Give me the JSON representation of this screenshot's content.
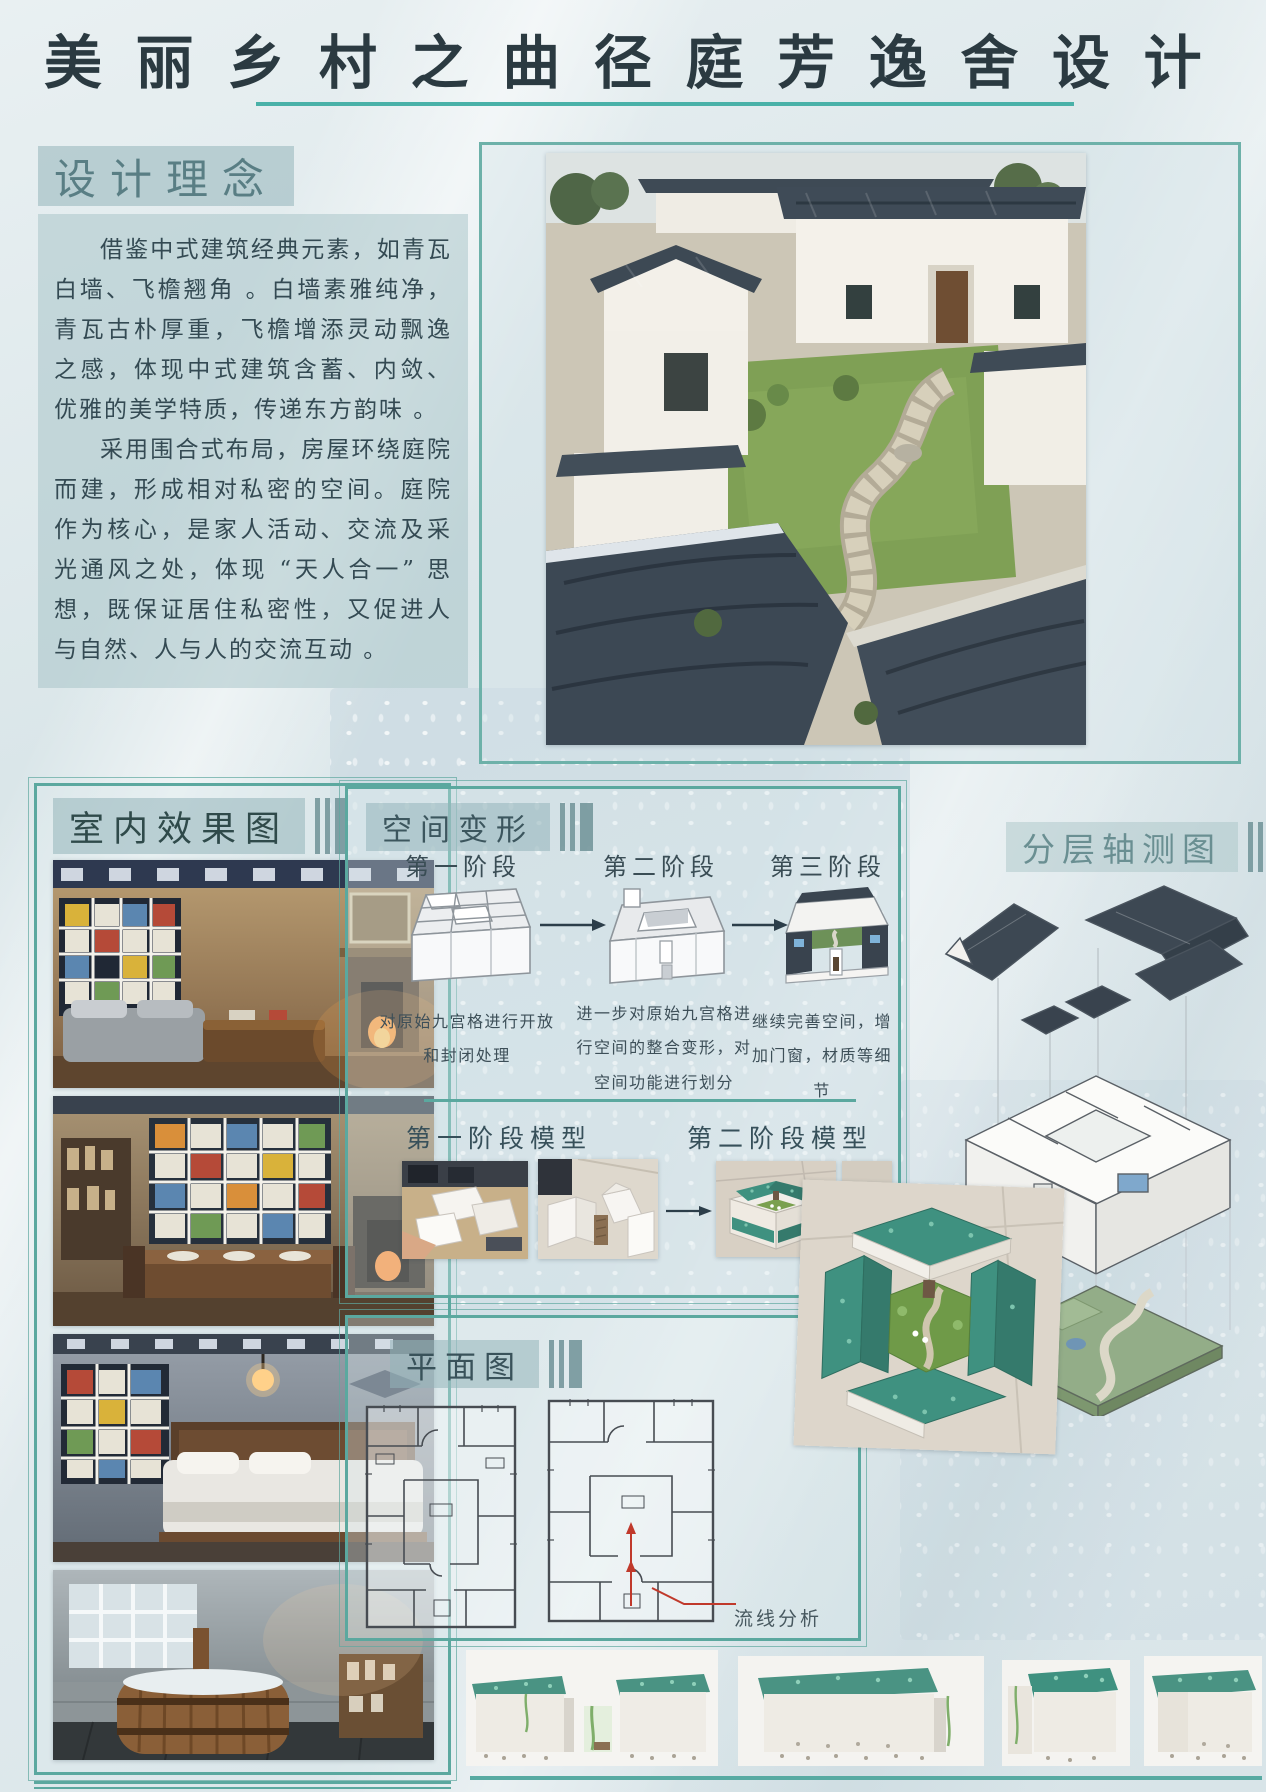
{
  "page": {
    "title": "美丽乡村之曲径庭芳逸舍设计"
  },
  "design_concept": {
    "heading": "设计理念",
    "paragraphs": [
      "借鉴中式建筑经典元素，如青瓦白墙、飞檐翘角 。白墙素雅纯净，青瓦古朴厚重，飞檐增添灵动飘逸之感，体现中式建筑含蓄、内敛、优雅的美学特质，传递东方韵味 。",
      "采用围合式布局，房屋环绕庭院而建，形成相对私密的空间。庭院作为核心，是家人活动、交流及采光通风之处，体现 “天人合一” 思想，既保证居住私密性，又促进人与自然、人与人的交流互动 。"
    ]
  },
  "interior": {
    "heading": "室内效果图"
  },
  "space_transform": {
    "heading": "空间变形",
    "stages": [
      {
        "label": "第一阶段",
        "caption": "对原始九宫格进行开放和封闭处理"
      },
      {
        "label": "第二阶段",
        "caption": "进一步对原始九宫格进行空间的整合变形，对空间功能进行划分"
      },
      {
        "label": "第三阶段",
        "caption": "继续完善空间，增加门窗，材质等细节"
      }
    ],
    "model_phase_labels": [
      "第一阶段模型",
      "第二阶段模型"
    ]
  },
  "axonometric": {
    "heading": "分层轴测图"
  },
  "floor_plan": {
    "heading": "平面图",
    "annotation": "流线分析"
  },
  "colors": {
    "accent_teal": "#5ba89f",
    "underline_teal": "#49b1a8",
    "title_text": "#2b3a41",
    "body_text": "#344a53",
    "roof_dark": "#3e4a56",
    "model_roof_green": "#3f9180",
    "lawn_green": "#7fa055",
    "flow_red": "#c0392b"
  }
}
